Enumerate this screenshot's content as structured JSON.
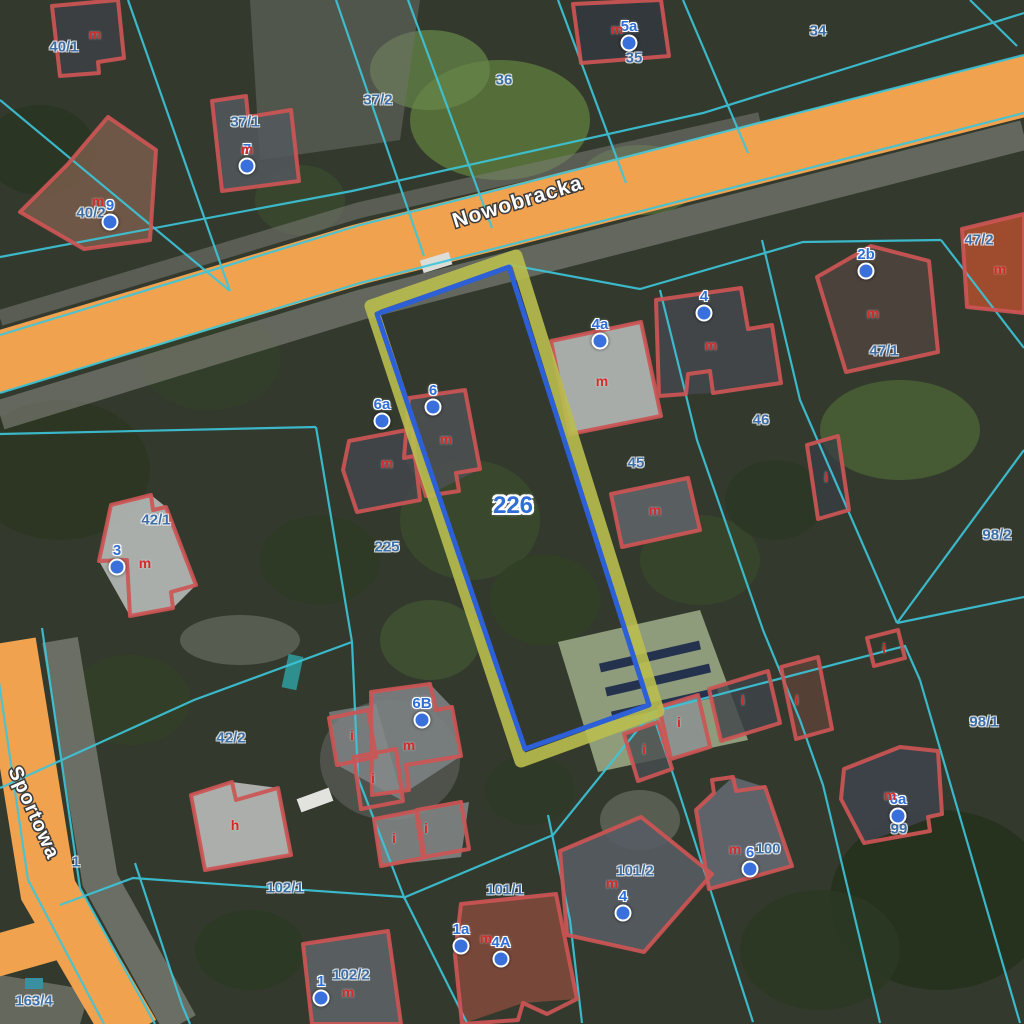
{
  "map": {
    "streets": [
      {
        "name": "Nowobracka"
      },
      {
        "name": "Sportowa"
      }
    ],
    "selected_parcel": {
      "number": "226"
    },
    "parcel_labels": [
      {
        "text": "40/1",
        "x": 64,
        "y": 47
      },
      {
        "text": "37/1",
        "x": 245,
        "y": 122
      },
      {
        "text": "37/2",
        "x": 378,
        "y": 100
      },
      {
        "text": "36",
        "x": 504,
        "y": 80
      },
      {
        "text": "35",
        "x": 634,
        "y": 58
      },
      {
        "text": "34",
        "x": 818,
        "y": 31
      },
      {
        "text": "40/2",
        "x": 91,
        "y": 213
      },
      {
        "text": "47/2",
        "x": 979,
        "y": 240
      },
      {
        "text": "47/1",
        "x": 884,
        "y": 351
      },
      {
        "text": "46",
        "x": 761,
        "y": 420
      },
      {
        "text": "45",
        "x": 636,
        "y": 463
      },
      {
        "text": "42/1",
        "x": 156,
        "y": 520
      },
      {
        "text": "226",
        "x": 513,
        "y": 506,
        "selected": true
      },
      {
        "text": "225",
        "x": 387,
        "y": 547
      },
      {
        "text": "98/2",
        "x": 997,
        "y": 535
      },
      {
        "text": "42/2",
        "x": 231,
        "y": 738
      },
      {
        "text": "98/1",
        "x": 984,
        "y": 722
      },
      {
        "text": "1",
        "x": 76,
        "y": 862
      },
      {
        "text": "102/1",
        "x": 285,
        "y": 888
      },
      {
        "text": "101/1",
        "x": 505,
        "y": 890
      },
      {
        "text": "101/2",
        "x": 635,
        "y": 871
      },
      {
        "text": "100",
        "x": 768,
        "y": 849
      },
      {
        "text": "99",
        "x": 899,
        "y": 829
      },
      {
        "text": "102/2",
        "x": 351,
        "y": 975
      },
      {
        "text": "163/4",
        "x": 34,
        "y": 1001
      }
    ],
    "address_points": [
      {
        "text": "5a",
        "x": 629,
        "y": 43
      },
      {
        "text": "7",
        "x": 247,
        "y": 166
      },
      {
        "text": "9",
        "x": 110,
        "y": 222
      },
      {
        "text": "2b",
        "x": 866,
        "y": 271
      },
      {
        "text": "4",
        "x": 704,
        "y": 313
      },
      {
        "text": "4a",
        "x": 600,
        "y": 341
      },
      {
        "text": "6",
        "x": 433,
        "y": 407
      },
      {
        "text": "6a",
        "x": 382,
        "y": 421
      },
      {
        "text": "3",
        "x": 117,
        "y": 567
      },
      {
        "text": "6B",
        "x": 422,
        "y": 720
      },
      {
        "text": "4",
        "x": 623,
        "y": 913
      },
      {
        "text": "6",
        "x": 750,
        "y": 869
      },
      {
        "text": "6a",
        "x": 898,
        "y": 816
      },
      {
        "text": "1a",
        "x": 461,
        "y": 946
      },
      {
        "text": "4A",
        "x": 501,
        "y": 959
      },
      {
        "text": "1",
        "x": 321,
        "y": 998
      }
    ],
    "building_letters": [
      {
        "text": "m",
        "x": 95,
        "y": 34
      },
      {
        "text": "m",
        "x": 617,
        "y": 29
      },
      {
        "text": "m",
        "x": 247,
        "y": 149
      },
      {
        "text": "m",
        "x": 98,
        "y": 201
      },
      {
        "text": "m",
        "x": 1000,
        "y": 269
      },
      {
        "text": "m",
        "x": 873,
        "y": 313
      },
      {
        "text": "m",
        "x": 711,
        "y": 345
      },
      {
        "text": "m",
        "x": 602,
        "y": 381
      },
      {
        "text": "m",
        "x": 446,
        "y": 439
      },
      {
        "text": "m",
        "x": 387,
        "y": 463
      },
      {
        "text": "m",
        "x": 145,
        "y": 563
      },
      {
        "text": "m",
        "x": 655,
        "y": 510
      },
      {
        "text": "i",
        "x": 826,
        "y": 477
      },
      {
        "text": "i",
        "x": 884,
        "y": 648
      },
      {
        "text": "m",
        "x": 409,
        "y": 745
      },
      {
        "text": "i",
        "x": 352,
        "y": 735
      },
      {
        "text": "i",
        "x": 373,
        "y": 778
      },
      {
        "text": "i",
        "x": 394,
        "y": 838
      },
      {
        "text": "i",
        "x": 426,
        "y": 828
      },
      {
        "text": "h",
        "x": 235,
        "y": 825
      },
      {
        "text": "i",
        "x": 644,
        "y": 749
      },
      {
        "text": "i",
        "x": 679,
        "y": 722
      },
      {
        "text": "i",
        "x": 743,
        "y": 700
      },
      {
        "text": "i",
        "x": 797,
        "y": 700
      },
      {
        "text": "m",
        "x": 486,
        "y": 938
      },
      {
        "text": "m",
        "x": 348,
        "y": 992
      },
      {
        "text": "m",
        "x": 612,
        "y": 883
      },
      {
        "text": "m",
        "x": 735,
        "y": 849
      },
      {
        "text": "m",
        "x": 890,
        "y": 795
      }
    ],
    "colors": {
      "road_fill": "#f0a24f",
      "boundary_cyan": "#3cc6da",
      "building_outline": "#cd5555",
      "selection_outer": "#b9be4f",
      "selection_inner": "#2d5fd6",
      "parcel_label": "#3d6fa6",
      "address_label": "#2f6fd6",
      "address_dot": "#3a70dc",
      "building_letter": "#d42a2a"
    }
  }
}
